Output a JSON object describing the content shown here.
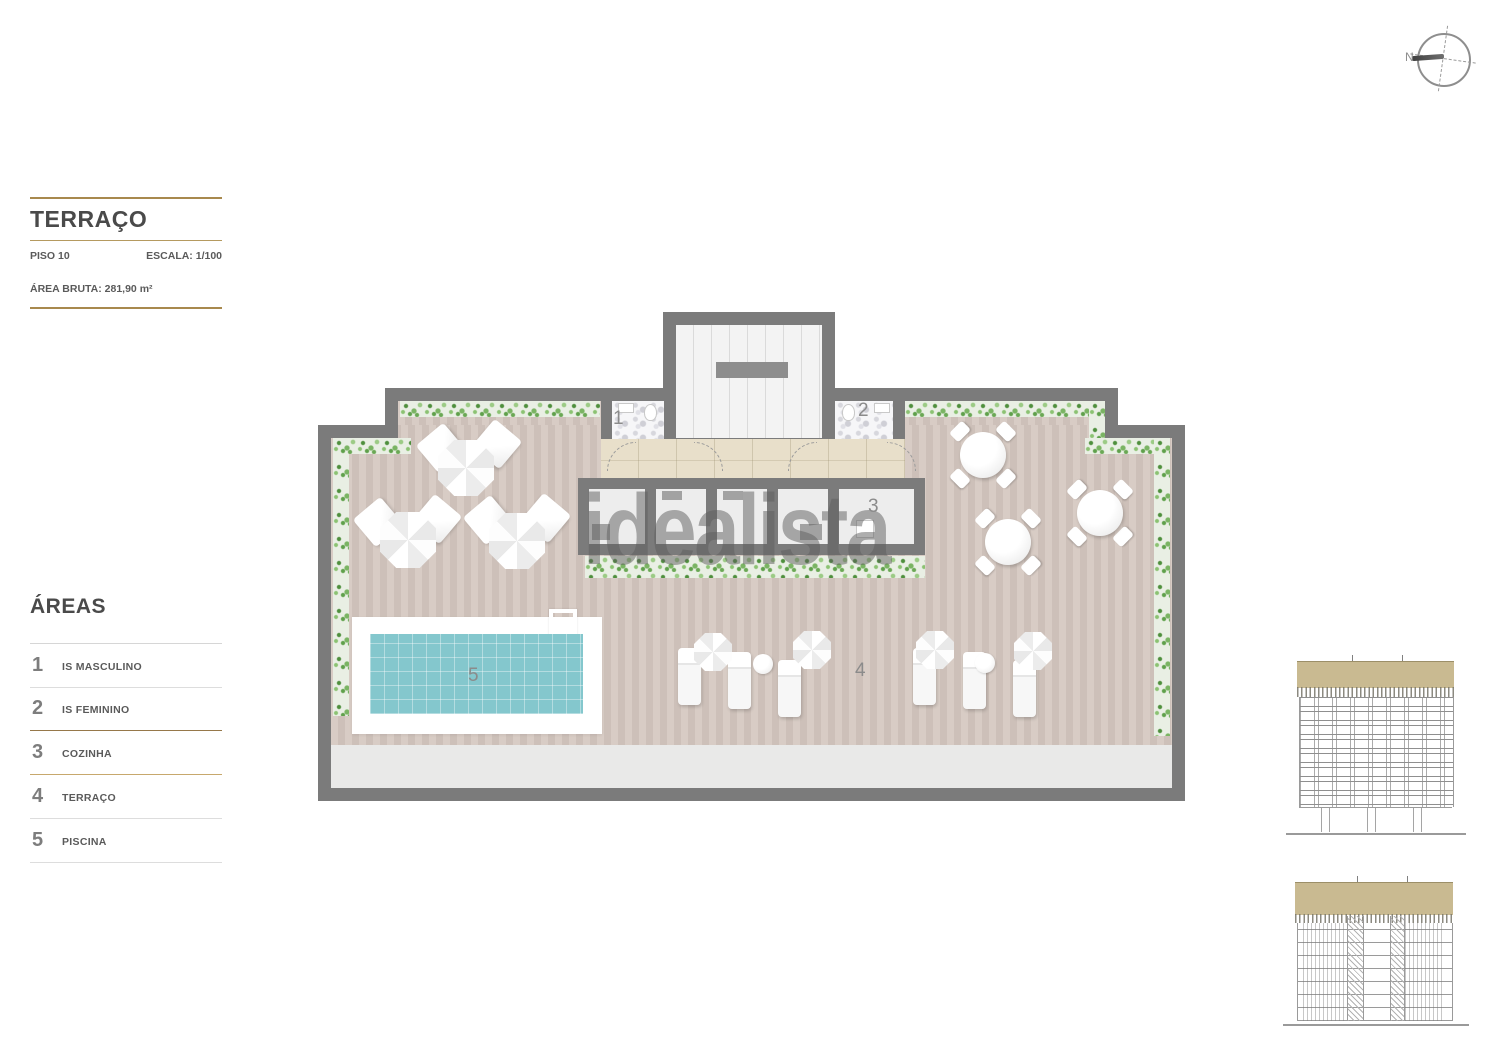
{
  "title_block": {
    "title": "TERRAÇO",
    "floor_label": "PISO 10",
    "scale_label": "ESCALA: 1/100",
    "area_label": "ÁREA BRUTA: 281,90 m²"
  },
  "areas_legend": {
    "heading": "ÁREAS",
    "items": [
      {
        "num": "1",
        "label": "IS MASCULINO"
      },
      {
        "num": "2",
        "label": "IS FEMININO"
      },
      {
        "num": "3",
        "label": "COZINHA"
      },
      {
        "num": "4",
        "label": "TERRAÇO"
      },
      {
        "num": "5",
        "label": "PISCINA"
      }
    ]
  },
  "plan": {
    "area_numbers": [
      "1",
      "2",
      "3",
      "4",
      "5"
    ]
  },
  "compass": {
    "north_label": "N"
  },
  "watermark": {
    "text": "idealista"
  },
  "colors": {
    "accent_gold": "#a8894d",
    "wall_gray": "#7b7b7b",
    "deck_pink": "#d5c8c1",
    "pool_teal": "#84c7cd",
    "plant_green": "#7ab463",
    "paving_beige": "#e8dfca",
    "elevation_band_tan": "#c9ba91",
    "watermark_gray": "#5f5f5f",
    "text_dark": "#4a4a4a"
  }
}
